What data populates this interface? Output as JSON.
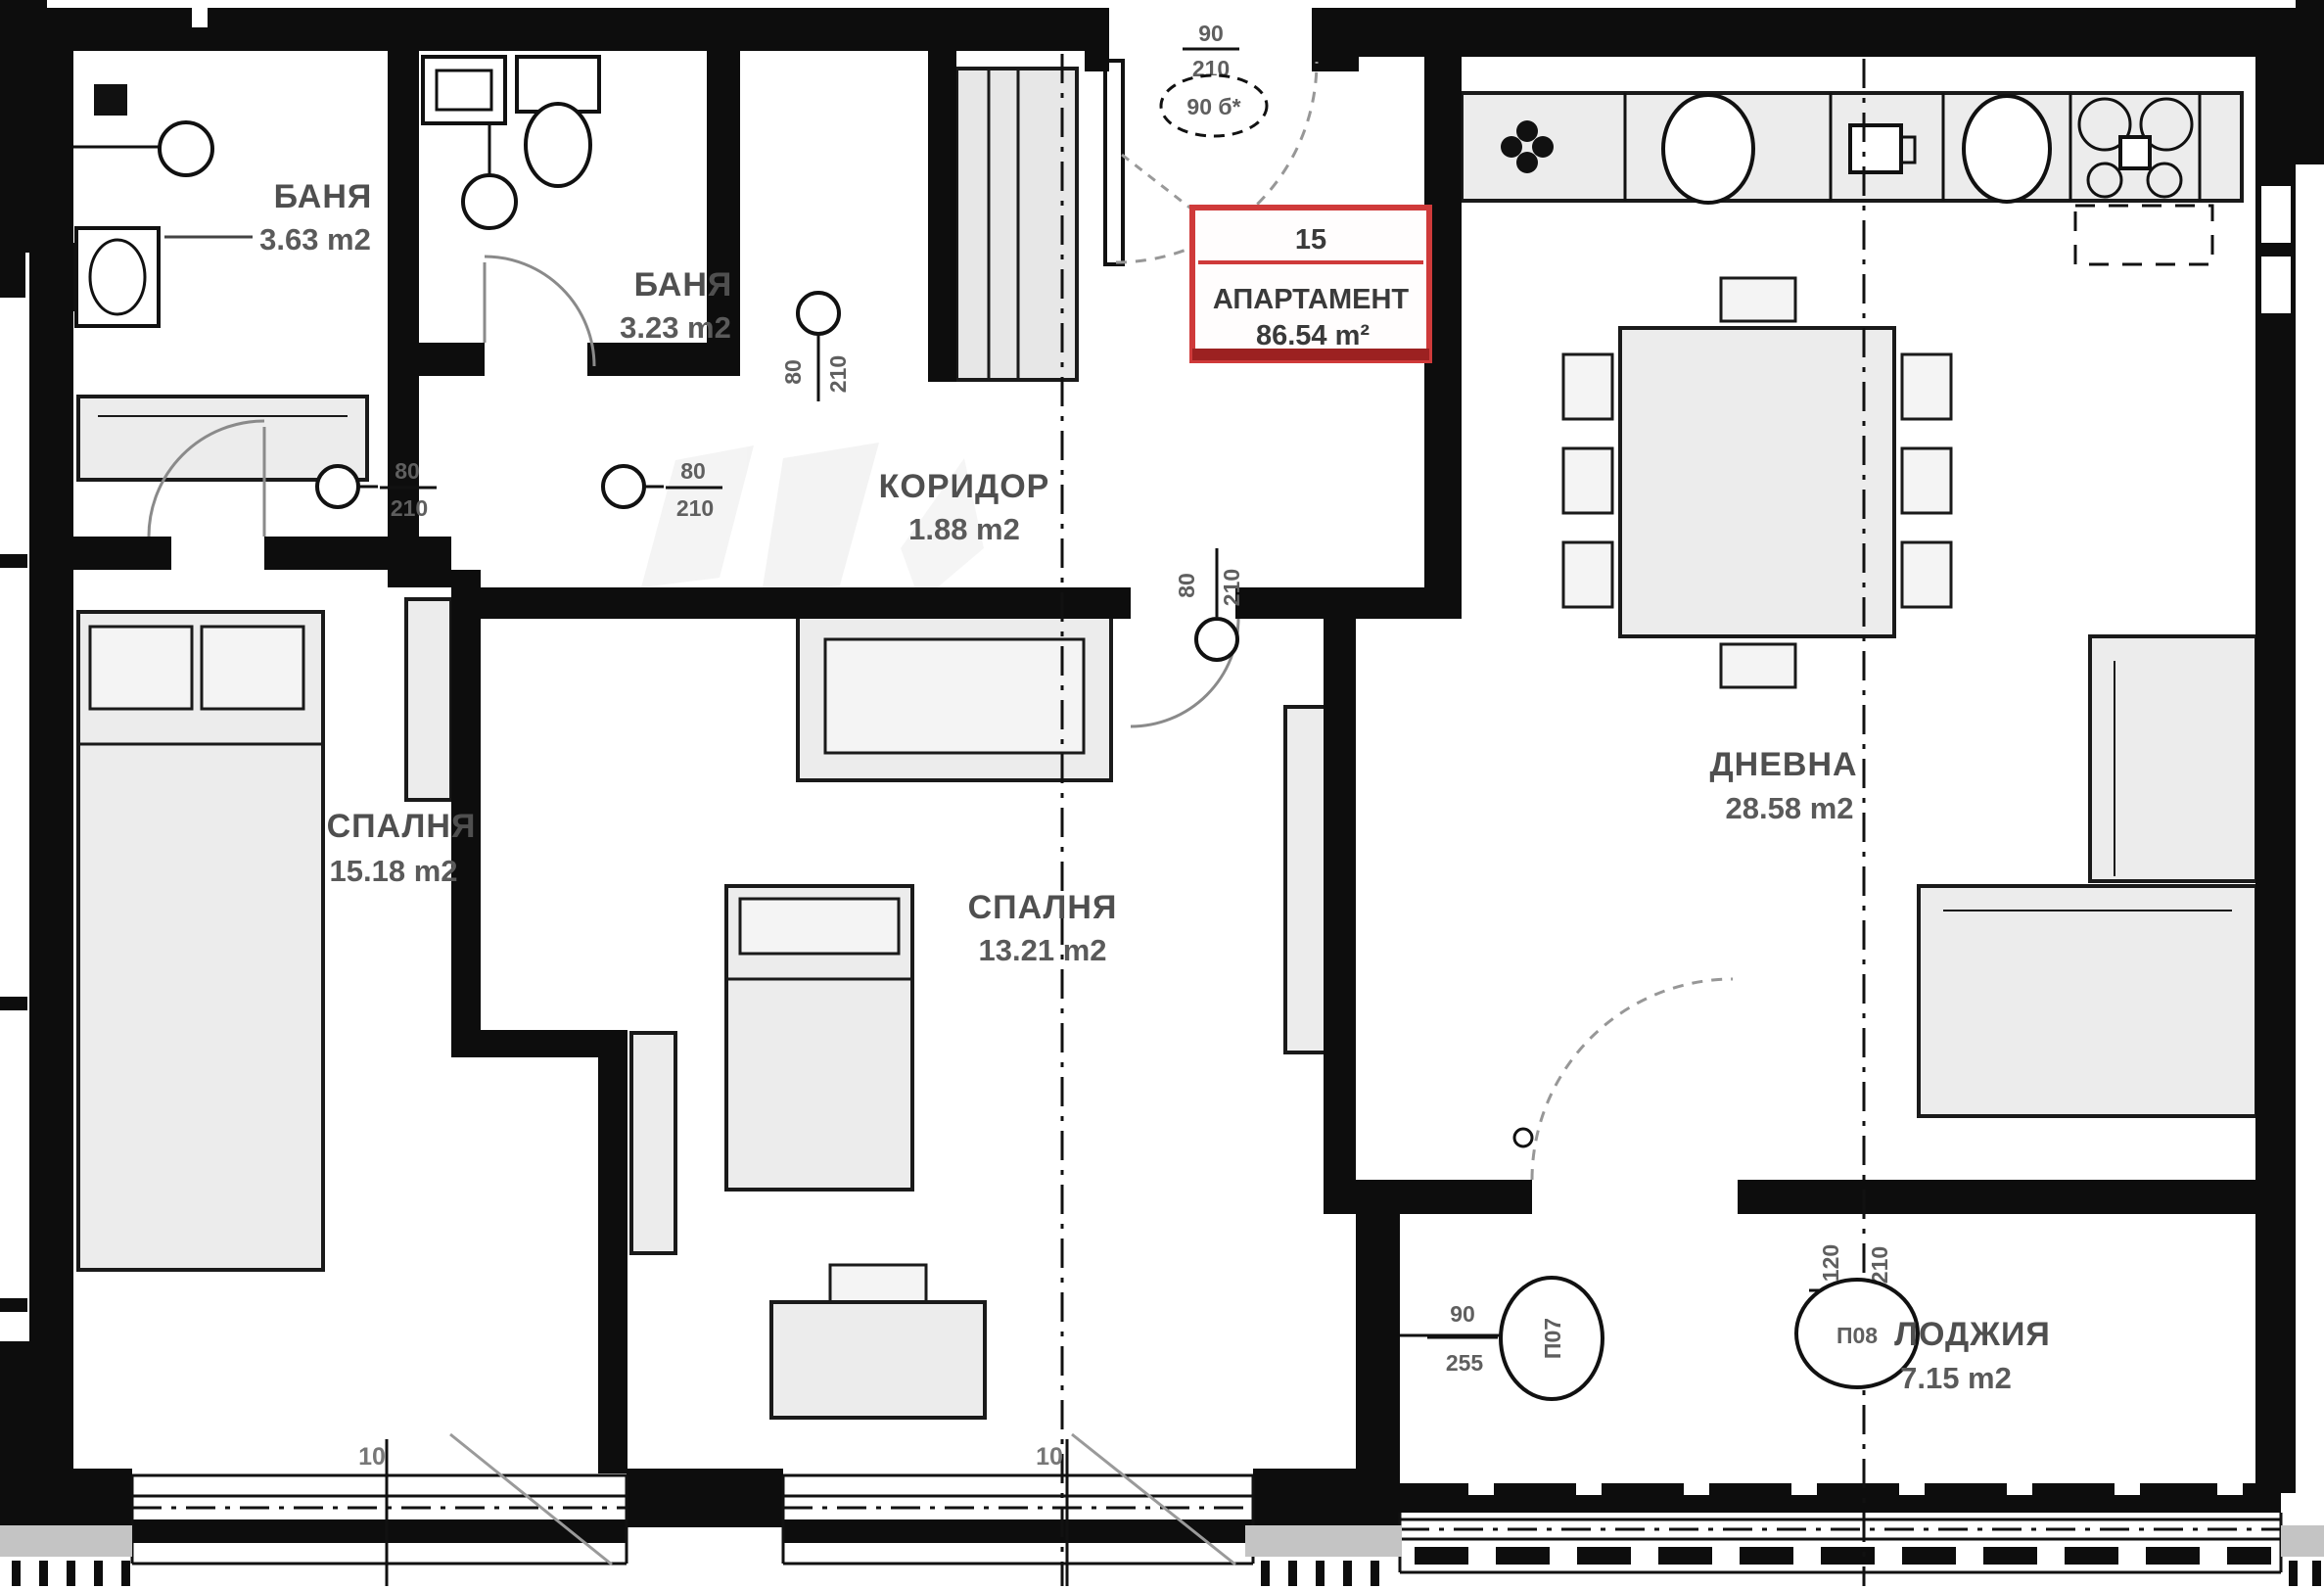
{
  "apartment": {
    "number": "15",
    "label": "АПАРТАМЕНТ",
    "area": "86.54 m²"
  },
  "rooms": {
    "bath1": {
      "name": "БАНЯ",
      "area": "3.63 m2"
    },
    "bath2": {
      "name": "БАНЯ",
      "area": "3.23 m2"
    },
    "corridor": {
      "name": "КОРИДОР",
      "area": "1.88 m2"
    },
    "bedroom1": {
      "name": "СПАЛНЯ",
      "area": "15.18 m2"
    },
    "bedroom2": {
      "name": "СПАЛНЯ",
      "area": "13.21 m2"
    },
    "living": {
      "name": "ДНЕВНА",
      "area": "28.58 m2"
    },
    "loggia": {
      "name": "ЛОДЖИЯ",
      "area": "7.15 m2"
    }
  },
  "doors": {
    "bath1": {
      "width": "80",
      "height": "210"
    },
    "bedroom1": {
      "width": "80",
      "height": "210"
    },
    "bath2": {
      "width": "80",
      "height": "210"
    },
    "bedroom2": {
      "width": "80",
      "height": "210"
    },
    "entrance": {
      "width": "90",
      "height": "210",
      "mark": "90 б*"
    },
    "loggia_door": {
      "width": "90",
      "height": "255",
      "mark": "П07"
    },
    "loggia_window": {
      "width": "120",
      "height": "210",
      "mark": "П08"
    }
  },
  "dimensions": {
    "window1": "10",
    "window2": "10"
  }
}
